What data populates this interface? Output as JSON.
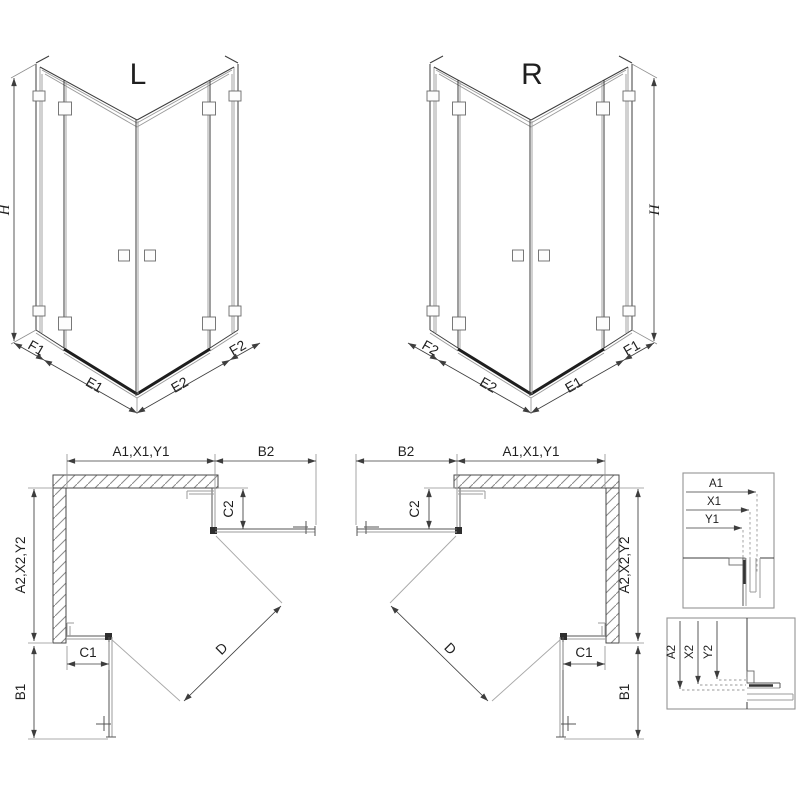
{
  "views_3d": {
    "left": {
      "variant_label": "L",
      "height_label": "H",
      "bottom_labels": [
        "F1",
        "E1",
        "E2",
        "F2"
      ]
    },
    "right": {
      "variant_label": "R",
      "height_label": "H",
      "bottom_labels": [
        "F2",
        "E2",
        "E1",
        "F1"
      ]
    }
  },
  "plans": {
    "left": {
      "top_width": "A1,X1,Y1",
      "open_door_top": "B2",
      "side_depth": "A2,X2,Y2",
      "fixed_side": "C2",
      "fixed_bottom": "C1",
      "open_door_side": "B1",
      "diagonal_entry": "D"
    },
    "right": {
      "top_width": "A1,X1,Y1",
      "open_door_top": "B2",
      "side_depth": "A2,X2,Y2",
      "fixed_side": "C2",
      "fixed_bottom": "C1",
      "open_door_side": "B1",
      "diagonal_entry": "D"
    }
  },
  "details": {
    "horizontal_section": {
      "labels": [
        "A1",
        "X1",
        "Y1"
      ]
    },
    "vertical_section": {
      "labels": [
        "A2",
        "X2",
        "Y2"
      ]
    }
  },
  "colors": {
    "background": "#ffffff",
    "line_dark": "#3c3c3c",
    "line_medium": "#555555",
    "line_light": "#9b9b9b",
    "dimension": "#3d3d3d",
    "threshold_bar": "#1e1e1e"
  }
}
